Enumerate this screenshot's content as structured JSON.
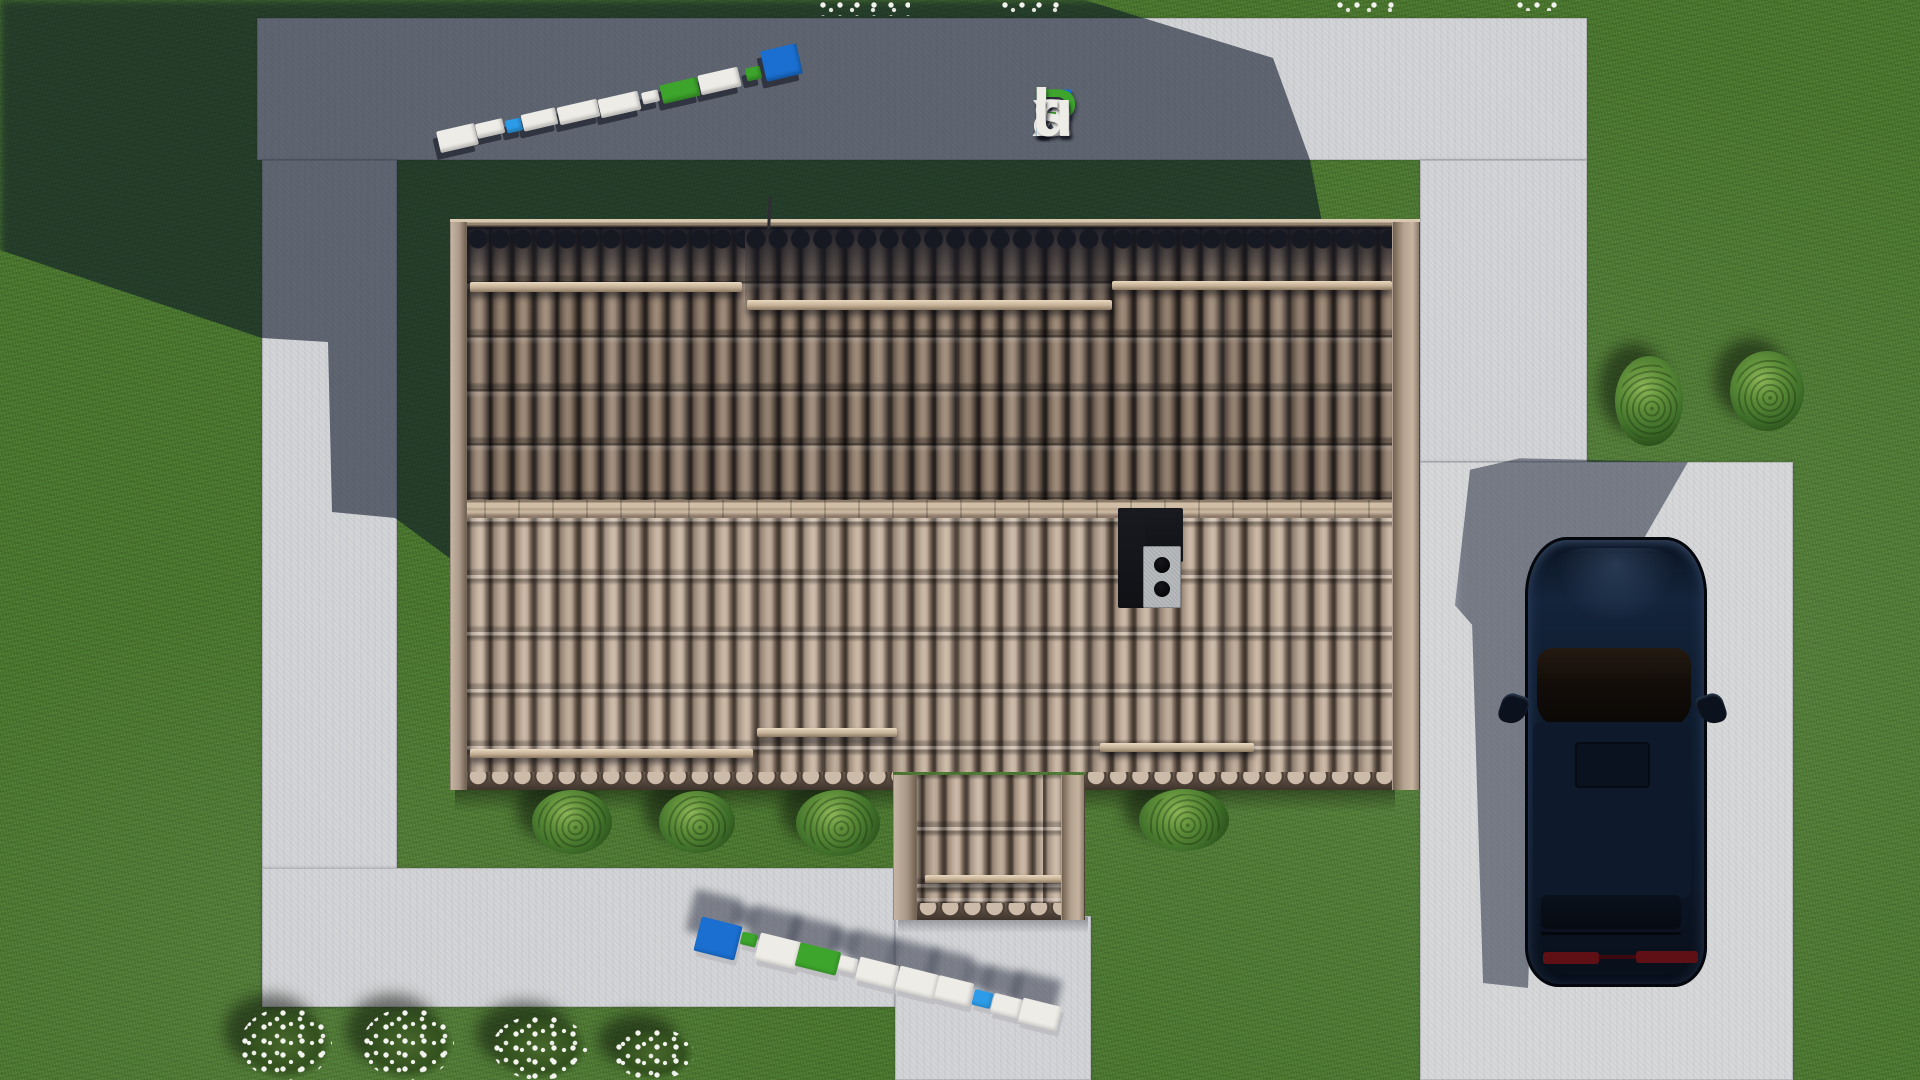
{
  "watermark": {
    "text": "FixPlans.ru",
    "letters": [
      {
        "char": "F",
        "color": "#1a6fd0"
      },
      {
        "char": "i",
        "color": "#3da52c"
      },
      {
        "char": "x",
        "color": "#eeece7"
      },
      {
        "char": "P",
        "color": "#3da52c"
      },
      {
        "char": "l",
        "color": "#eeece7"
      },
      {
        "char": "a",
        "color": "#eeece7"
      },
      {
        "char": "n",
        "color": "#eeece7"
      },
      {
        "char": "s",
        "color": "#eeece7"
      },
      {
        "char": ".",
        "color": "#2d9ce8"
      },
      {
        "char": "r",
        "color": "#eeece7"
      },
      {
        "char": "u",
        "color": "#eeece7"
      }
    ],
    "instances": [
      "logo-overlay-top-right",
      "ground-3d-text-top-left",
      "ground-3d-text-bottom-center"
    ]
  },
  "scene": {
    "description": "Aerial top-down 3D render of a house site plan: tiled gable roof with chimney, concrete walkways, driveway with parked dark SUV, lawn with bushes and white flower patches, long shadow cast to the upper left.",
    "colors": {
      "grass": "#4a772e",
      "grass_shadow": "#1d2e16",
      "concrete": "#d2d3d6",
      "concrete_shadow": "#707690",
      "roof_tiles_upper": "#7d6a5c",
      "roof_tiles_lower": "#b4a292",
      "roof_trim": "#cdbba4",
      "roof_eave_dark": "#171922",
      "chimney_body": "#15161b",
      "chimney_cap": "#b7babd",
      "car_body": "#0d1725",
      "car_glass": "#13100d",
      "car_taillight": "#5f1014",
      "bush": "#40702a",
      "flowers": "#f3f3ef"
    }
  }
}
